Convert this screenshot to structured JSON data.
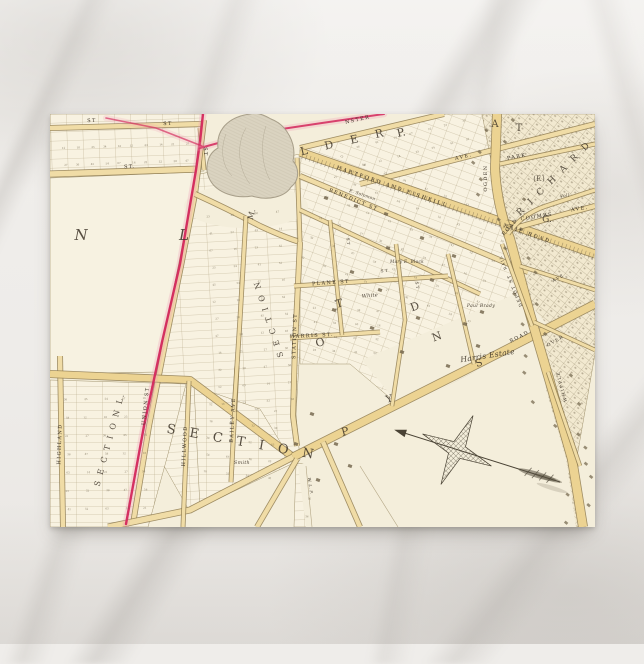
{
  "scene": {
    "canvas": {
      "w": 644,
      "h": 644
    },
    "surface_colors": {
      "base": "#efedea",
      "vein": "#c9c5c0"
    },
    "postcard": {
      "x": 50,
      "y": 114,
      "w": 545,
      "h": 413,
      "paper": "#f4edd9"
    }
  },
  "map": {
    "palette": {
      "paper": "#f4eedb",
      "block": "#f8f2e1",
      "block_line": "#a2946f",
      "road_fill": "#f0dca6",
      "road_fill_major": "#ecd392",
      "road_casing": "#8f7b4f",
      "pink": "#d3285c",
      "pink_glow": "#ef9ab5",
      "pond_fill": "#dad3c0",
      "pond_line": "#a79e89",
      "ink": "#3b3226",
      "ink_soft": "#6b6049",
      "building": "#6f6249",
      "dense_fill": "#f2e9d0",
      "compass_ink": "#4a4335"
    },
    "zones": [
      {
        "n": "grid-top-left",
        "pts": [
          [
            0,
            0
          ],
          [
            152,
            0
          ],
          [
            154,
            57
          ],
          [
            0,
            62
          ]
        ],
        "p": "lotsA"
      },
      {
        "n": "grid-top-wedge",
        "pts": [
          [
            250,
            34
          ],
          [
            396,
            0
          ],
          [
            460,
            0
          ],
          [
            472,
            120
          ],
          [
            250,
            66
          ]
        ],
        "p": "lots20"
      },
      {
        "n": "grid-mid-band",
        "pts": [
          [
            150,
            60
          ],
          [
            250,
            40
          ],
          [
            256,
            130
          ],
          [
            246,
            300
          ],
          [
            250,
            346
          ],
          [
            140,
            398
          ],
          [
            96,
            320
          ],
          [
            130,
            152
          ],
          [
            146,
            82
          ]
        ],
        "p": "rows"
      },
      {
        "n": "grid-lower-left",
        "pts": [
          [
            0,
            266
          ],
          [
            136,
            270
          ],
          [
            118,
            340
          ],
          [
            98,
            413
          ],
          [
            0,
            413
          ]
        ],
        "p": "rows0"
      },
      {
        "n": "grid-bailey",
        "pts": [
          [
            144,
            272
          ],
          [
            210,
            295
          ],
          [
            240,
            344
          ],
          [
            150,
            394
          ]
        ],
        "p": "rows0"
      },
      {
        "n": "grid-fan",
        "pts": [
          [
            250,
            36
          ],
          [
            472,
            118
          ],
          [
            486,
            212
          ],
          [
            424,
            258
          ],
          [
            352,
            294
          ],
          [
            300,
            250
          ],
          [
            250,
            250
          ]
        ],
        "p": "lots20"
      },
      {
        "n": "grid-bottom-strip",
        "pts": [
          [
            246,
            350
          ],
          [
            272,
            348
          ],
          [
            266,
            413
          ],
          [
            244,
            413
          ]
        ],
        "p": "lotsA"
      },
      {
        "n": "dense-east",
        "pts": [
          [
            432,
            0
          ],
          [
            545,
            0
          ],
          [
            545,
            240
          ],
          [
            524,
            360
          ],
          [
            536,
            413
          ],
          [
            508,
            413
          ],
          [
            494,
            300
          ],
          [
            468,
            178
          ],
          [
            444,
            62
          ]
        ],
        "p": "dense",
        "f": "#f2e9d0"
      }
    ],
    "plains": [
      {
        "n": "white-block",
        "pts": [
          [
            0,
            64
          ],
          [
            148,
            58
          ],
          [
            144,
            84
          ],
          [
            128,
            154
          ],
          [
            112,
            232
          ],
          [
            108,
            258
          ],
          [
            0,
            260
          ]
        ],
        "f": "#f7f2e1",
        "stroke": true
      },
      {
        "n": "pond-surround",
        "ellipse": [
          196,
          92,
          62,
          22
        ]
      },
      {
        "n": "se-empty",
        "pts": [
          [
            248,
            352
          ],
          [
            424,
            258
          ],
          [
            492,
            222
          ],
          [
            496,
            275
          ],
          [
            516,
            345
          ],
          [
            526,
            413
          ],
          [
            256,
            413
          ]
        ]
      },
      {
        "n": "harris-estate-area",
        "pts": [
          [
            312,
            246
          ],
          [
            470,
            178
          ],
          [
            500,
            214
          ],
          [
            424,
            258
          ],
          [
            352,
            295
          ]
        ]
      }
    ],
    "roads": [
      {
        "n": "st-top-1",
        "d": "M0,14 L152,10",
        "w": 6
      },
      {
        "n": "st-top-cross",
        "d": "M150,14 L154,56",
        "w": 5
      },
      {
        "n": "st-top-2",
        "d": "M0,60 L150,55",
        "w": 7
      },
      {
        "n": "union-st",
        "d": "M154,6 L148,56 L145,80 L131,152 L115,230 L99,312 L83,410",
        "w": 6
      },
      {
        "n": "pond-curve",
        "d": "M145,80 Q180,96 210,112 Q236,124 250,128",
        "w": 6
      },
      {
        "n": "pond-east-link",
        "d": "M247,44 L250,128",
        "w": 5
      },
      {
        "n": "highland",
        "d": "M10,242 L13,413",
        "w": 6
      },
      {
        "n": "mid-cross-road",
        "d": "M0,260 L140,266 L243,343",
        "w": 8,
        "major": true
      },
      {
        "n": "road-diagonal",
        "d": "M243,343 L420,254 L545,190",
        "w": 9,
        "major": true
      },
      {
        "n": "sw-road",
        "d": "M243,343 L140,396 L58,413",
        "w": 7
      },
      {
        "n": "south-road-1",
        "d": "M247,345 L207,413",
        "w": 6
      },
      {
        "n": "south-road-2",
        "d": "M273,328 L310,413",
        "w": 6
      },
      {
        "n": "hillwood",
        "d": "M139,267 L133,413",
        "w": 5
      },
      {
        "n": "bailey-ave",
        "d": "M187,252 L181,368",
        "w": 5
      },
      {
        "n": "mid-vertical",
        "d": "M196,102 L190,205 L184,298",
        "w": 5
      },
      {
        "n": "station-st",
        "d": "M250,128 L245,232 L243,302 L247,332",
        "w": 6
      },
      {
        "n": "nster-st",
        "d": "M250,34 L394,0",
        "w": 6
      },
      {
        "n": "ave-upper",
        "d": "M310,70 L545,10",
        "w": 6
      },
      {
        "n": "railroad",
        "d": "M250,38 L545,140",
        "w": 9,
        "major": true
      },
      {
        "n": "benedict-st",
        "d": "M250,62 L478,158",
        "w": 6
      },
      {
        "n": "mid-fan-st",
        "d": "M250,96 L430,180",
        "w": 5
      },
      {
        "n": "plane-st",
        "d": "M244,172 L398,162",
        "w": 5
      },
      {
        "n": "harris-st",
        "d": "M240,224 L330,218",
        "w": 5
      },
      {
        "n": "cross-1",
        "d": "M280,106 L292,221",
        "w": 4.5
      },
      {
        "n": "cross-2",
        "d": "M346,130 L355,206 L342,292",
        "w": 4.5
      },
      {
        "n": "cross-3",
        "d": "M398,140 L424,250",
        "w": 4.5
      },
      {
        "n": "artery",
        "d": "M447,0 L445,55 Q447,92 460,125 L480,200 L502,275 L522,345 L533,413",
        "w": 10,
        "major": true
      },
      {
        "n": "park-st",
        "d": "M450,50 L545,30",
        "w": 5
      },
      {
        "n": "coombs-ave",
        "d": "M458,116 Q500,104 545,92",
        "w": 6
      },
      {
        "n": "ne-road",
        "d": "M458,120 Q472,100 496,92 L545,76",
        "w": 5
      },
      {
        "n": "depot-st",
        "d": "M452,130 L482,212",
        "w": 4.5
      },
      {
        "n": "dyer-ave",
        "d": "M470,152 L545,176",
        "w": 4.5
      },
      {
        "n": "over-st",
        "d": "M484,208 L545,236",
        "w": 4.5
      },
      {
        "n": "whipple-st",
        "d": "M498,258 L530,352",
        "w": 4.5
      }
    ],
    "railroad_ticks": {
      "d": "M252,42 L545,143"
    },
    "boundary_lines": [
      {
        "d": "M256,352 L262,413"
      },
      {
        "d": "M310,352 L348,413"
      }
    ],
    "pond": {
      "d": "M200,0 C178,3 166,16 168,34 C157,40 154,55 160,66 C167,79 186,85 202,82 C218,87 235,83 241,73 C250,66 249,54 243,47 C247,30 237,11 221,5 C214,1 207,-2 200,0 Z",
      "inner": [
        "M176,20 C170,35 172,52 182,62",
        "M196,14 C186,30 188,55 200,70",
        "M216,12 C210,30 212,52 220,66"
      ]
    },
    "pink_line": {
      "branches": [
        {
          "d": "M153,0 L150,28 L146,56 L130,150 L112,228 L94,312 L76,410",
          "w": 2.4,
          "o": 1
        },
        {
          "d": "M334,0 L272,9 L205,19 L150,34",
          "w": 2,
          "o": 0.9
        },
        {
          "d": "M152,32 L106,14 L56,4",
          "w": 1.6,
          "o": 0.7
        }
      ]
    },
    "street_labels": [
      {
        "t": "ST",
        "x": 42,
        "y": 8,
        "r": -2
      },
      {
        "t": "ST",
        "x": 118,
        "y": 11,
        "r": -2
      },
      {
        "t": "ST",
        "x": 154,
        "y": 38,
        "r": 88
      },
      {
        "t": "ST.",
        "x": 80,
        "y": 54,
        "r": -2
      },
      {
        "t": "UNION ST",
        "x": 97,
        "y": 292,
        "r": -84
      },
      {
        "t": "HIGHLAND",
        "x": 11,
        "y": 330,
        "r": -88
      },
      {
        "t": "HILLWOOD",
        "x": 136,
        "y": 332,
        "r": -87
      },
      {
        "t": "BAILEY AVE",
        "x": 184,
        "y": 306,
        "r": -87
      },
      {
        "t": "STATION ST",
        "x": 246,
        "y": 222,
        "r": -88
      },
      {
        "t": "NSTER",
        "x": 308,
        "y": 7,
        "r": -13
      },
      {
        "t": "AVE.",
        "x": 414,
        "y": 44,
        "r": -14
      },
      {
        "t": "HARTFORD AND FISHKILL",
        "x": 342,
        "y": 74,
        "r": 19,
        "ls": 2.2
      },
      {
        "t": "RAIL ROAD",
        "x": 477,
        "y": 121,
        "r": 19,
        "ls": 2.2
      },
      {
        "t": "BENEDICT ST",
        "x": 303,
        "y": 87,
        "r": 22
      },
      {
        "t": "PLANE ST",
        "x": 281,
        "y": 170,
        "r": -4
      },
      {
        "t": "HARRIS ST.",
        "x": 262,
        "y": 223,
        "r": -3
      },
      {
        "t": "ST",
        "x": 335,
        "y": 158,
        "r": -5,
        "s": 4
      },
      {
        "t": "ST",
        "x": 297,
        "y": 128,
        "r": 85,
        "s": 4
      },
      {
        "t": "ST",
        "x": 366,
        "y": 172,
        "r": 82,
        "s": 4
      },
      {
        "t": "OGDEN",
        "x": 437,
        "y": 64,
        "r": -90
      },
      {
        "t": "PARK",
        "x": 467,
        "y": 44,
        "r": -11
      },
      {
        "t": "COOMBS",
        "x": 487,
        "y": 104,
        "r": -9
      },
      {
        "t": "AVE.",
        "x": 530,
        "y": 96,
        "r": -9
      },
      {
        "t": "ROAD",
        "x": 461,
        "y": 114,
        "r": -48
      },
      {
        "t": "ROAD",
        "x": 470,
        "y": 224,
        "r": -27
      },
      {
        "t": "DEPOT ST",
        "x": 466,
        "y": 176,
        "r": -112,
        "s": 4.4
      },
      {
        "t": "RAIL",
        "x": 454,
        "y": 148,
        "r": -112,
        "s": 3.8
      },
      {
        "t": "AVE",
        "x": 509,
        "y": 165,
        "r": -30,
        "s": 4.2
      },
      {
        "t": "OVER",
        "x": 506,
        "y": 228,
        "r": -30,
        "s": 4.4
      },
      {
        "t": "WHIPPLE",
        "x": 513,
        "y": 272,
        "r": -105,
        "s": 4.4
      }
    ],
    "ornate_letters": [
      {
        "t": "N",
        "x": 31,
        "y": 126,
        "s": 15,
        "i": 1
      },
      {
        "t": "L",
        "x": 134,
        "y": 126,
        "s": 15,
        "i": 1
      },
      {
        "t": "S E C T I O N  L.",
        "x": 62,
        "y": 326,
        "r": -75,
        "s": 8,
        "ls": 2
      },
      {
        "t": "S E C T I O N",
        "x": 221,
        "y": 204,
        "r": -108,
        "s": 8,
        "ls": 2
      },
      {
        "t": "S E C T I O N",
        "x": 192,
        "y": 332,
        "r": 10,
        "s": 13,
        "ls": 5
      },
      {
        "t": "R I C H A R D",
        "x": 506,
        "y": 66,
        "r": -45,
        "s": 9,
        "ls": 3
      },
      {
        "t": "L D E R",
        "x": 296,
        "y": 31,
        "r": -13,
        "s": 11,
        "ls": 7
      },
      {
        "t": "P.",
        "x": 352,
        "y": 22,
        "r": -13,
        "s": 11
      },
      {
        "t": "A",
        "x": 445,
        "y": 13,
        "s": 10
      },
      {
        "t": "T",
        "x": 469,
        "y": 17,
        "s": 10
      },
      {
        "t": "(F.)",
        "x": 489,
        "y": 67,
        "s": 7
      },
      {
        "t": "G.",
        "x": 497,
        "y": 108,
        "s": 9
      },
      {
        "t": "M.",
        "x": 204,
        "y": 101,
        "r": -75,
        "s": 8
      },
      {
        "t": "T",
        "x": 290,
        "y": 193,
        "r": -15,
        "s": 11
      },
      {
        "t": "O",
        "x": 271,
        "y": 232,
        "r": -15,
        "s": 11
      },
      {
        "t": "Y",
        "x": 340,
        "y": 288,
        "r": -15,
        "s": 10
      },
      {
        "t": "P",
        "x": 296,
        "y": 321,
        "r": -15,
        "s": 11
      },
      {
        "t": "D",
        "x": 366,
        "y": 196,
        "r": -20,
        "s": 11
      },
      {
        "t": "N",
        "x": 388,
        "y": 226,
        "r": -20,
        "s": 11
      },
      {
        "t": "S",
        "x": 430,
        "y": 252,
        "r": -20,
        "s": 10
      }
    ],
    "estate_labels": [
      {
        "t": "Harris Estate",
        "x": 438,
        "y": 244,
        "r": -9,
        "s": 7.5
      },
      {
        "t": "White",
        "x": 320,
        "y": 183,
        "r": -5,
        "s": 5
      },
      {
        "t": "E. Solomon",
        "x": 312,
        "y": 82,
        "r": 19,
        "s": 4.2
      },
      {
        "t": "Mary E. Block",
        "x": 357,
        "y": 149,
        "r": 0,
        "s": 4.2
      },
      {
        "t": "Paul Brady",
        "x": 431,
        "y": 193,
        "r": 0,
        "s": 4.6
      },
      {
        "t": "Voll",
        "x": 515,
        "y": 83,
        "r": -10,
        "s": 4.2
      },
      {
        "t": "Smith",
        "x": 192,
        "y": 350,
        "r": 0,
        "s": 4.8
      },
      {
        "t": "W. L. P.",
        "x": 259,
        "y": 372,
        "r": 82,
        "s": 4
      }
    ],
    "lot_numbers_sample": [
      "12",
      "14",
      "16",
      "18",
      "21",
      "23",
      "25",
      "27",
      "32",
      "34",
      "36",
      "38",
      "41",
      "45",
      "47",
      "52",
      "54",
      "58",
      "63",
      "67"
    ],
    "number_fields": [
      [
        8,
        20,
        136,
        34,
        10,
        2,
        -2
      ],
      [
        154,
        88,
        92,
        205,
        4,
        12,
        -4
      ],
      [
        8,
        272,
        96,
        128,
        5,
        7,
        -1
      ],
      [
        148,
        282,
        86,
        84,
        4,
        5,
        6
      ],
      [
        258,
        56,
        200,
        130,
        9,
        6,
        21
      ],
      [
        254,
        186,
        84,
        56,
        4,
        4,
        3
      ],
      [
        300,
        6,
        126,
        38,
        7,
        2,
        -14
      ],
      [
        250,
        354,
        18,
        54,
        1,
        3,
        4
      ]
    ],
    "buildings_scatter": [
      [
        330,
        176
      ],
      [
        368,
        204
      ],
      [
        322,
        214
      ],
      [
        382,
        166
      ],
      [
        302,
        158
      ],
      [
        415,
        210
      ],
      [
        352,
        238
      ],
      [
        284,
        196
      ],
      [
        428,
        232
      ],
      [
        398,
        252
      ],
      [
        262,
        300
      ],
      [
        286,
        330
      ],
      [
        268,
        366
      ],
      [
        246,
        330
      ],
      [
        300,
        352
      ],
      [
        338,
        134
      ],
      [
        306,
        92
      ],
      [
        336,
        100
      ],
      [
        372,
        124
      ],
      [
        404,
        142
      ],
      [
        276,
        84
      ],
      [
        432,
        198
      ]
    ],
    "artery_pts": [
      [
        447,
        0
      ],
      [
        445,
        55
      ],
      [
        460,
        125
      ],
      [
        480,
        200
      ],
      [
        502,
        275
      ],
      [
        522,
        345
      ],
      [
        533,
        413
      ]
    ],
    "compass": {
      "cx": 407,
      "cy": 336,
      "r": 38,
      "rv": 9,
      "rot": 25,
      "arrow": {
        "x1": 348,
        "y1": 317,
        "x2": 510,
        "y2": 368
      }
    }
  }
}
